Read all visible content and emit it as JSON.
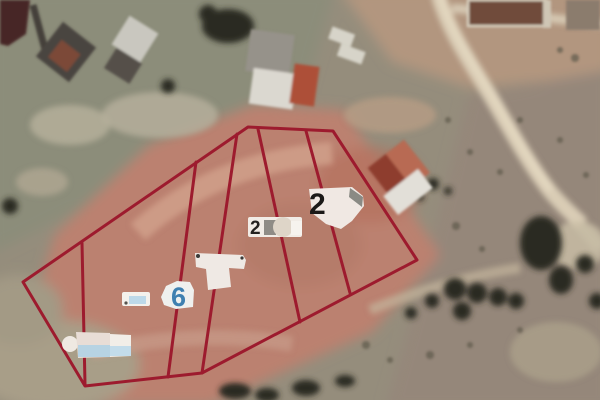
{
  "map": {
    "overlay": {
      "boundary_color": "#9d1b2e",
      "parcel_count": 6,
      "outer_points": "248,127 333,131 417,260 202,373 85,386 23,282",
      "dividers": {
        "d1": "82,243 85,384",
        "d2": "196,162 168,377",
        "d3": "237,134 202,373",
        "d4": "258,129 300,322",
        "d5": "306,131 350,293"
      }
    },
    "labels": {
      "top_parcel": {
        "text": "2",
        "color": "#1b1918"
      },
      "middle_parcel": {
        "text": "2",
        "color": "#242220"
      },
      "lower_parcel": {
        "text": "6",
        "color": "#3f80b0"
      }
    },
    "palette": {
      "parcel_soil": "#bb8170",
      "upper_terrain": "#8c8d7a",
      "right_terrain": "#95877a",
      "road": "#d9ccb5",
      "trees": "#2a2b23",
      "label_blob": "#efe8e2"
    }
  }
}
